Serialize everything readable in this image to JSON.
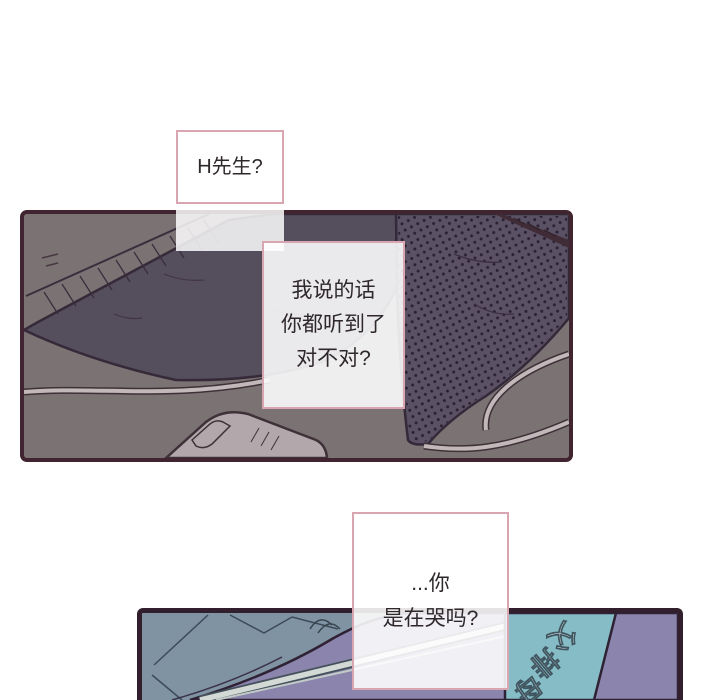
{
  "comic": {
    "bubble1": {
      "text": "H先生?"
    },
    "bubble2": {
      "lines": [
        "我说的话",
        "你都听到了",
        "对不对?"
      ]
    },
    "bubble3": {
      "lines": [
        "...你",
        "是在哭吗?"
      ]
    },
    "panel2": {
      "rotated_chars": [
        "父",
        "排",
        "母"
      ]
    },
    "colors": {
      "page_background": "#ffffff",
      "bubble_border": "#d9a5b0",
      "bubble_fill": "rgba(255,255,255,0.88)",
      "text": "#2e282b",
      "panel1_border": "#40242f",
      "panel1_background": "#7b7274",
      "blanket": "#554e5d",
      "dotted_mass": "#5a5264",
      "dot": "#2a2233",
      "cable": "#c2b8ba",
      "mouse_object": "#b2a8ab",
      "panel2_border": "#321f2d",
      "panel2_blue": "#8093a3",
      "panel2_purple": "#8b84ad",
      "panel2_teal": "#86bcc6",
      "stick": "#d3dad6"
    }
  }
}
